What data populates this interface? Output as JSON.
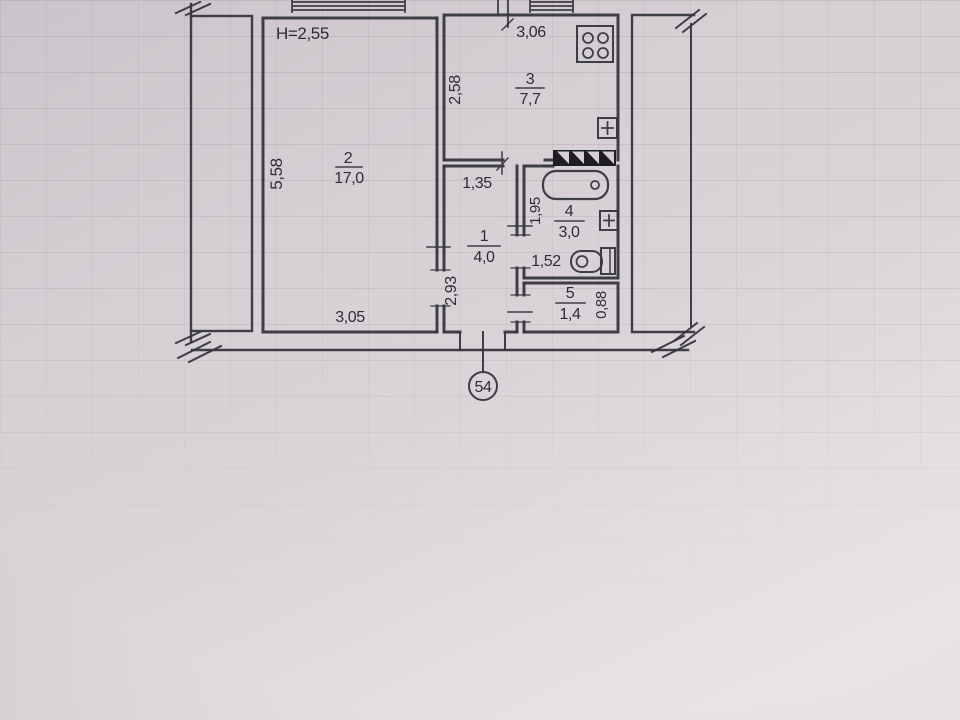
{
  "plan": {
    "title_note": "photographed BTI floor plan sheet",
    "ceiling_height": "H=2,55",
    "apartment_number": "54",
    "rooms": {
      "living": {
        "number": "2",
        "area": "17,0",
        "width": "3,05",
        "depth": "5,58"
      },
      "kitchen": {
        "number": "3",
        "area": "7,7",
        "width": "3,06",
        "depth": "2,58"
      },
      "hall": {
        "number": "1",
        "area": "4,0",
        "width": "1,35",
        "depth": "2,93"
      },
      "bathroom": {
        "number": "4",
        "area": "3,0",
        "width": "1,52",
        "depth": "1,95"
      },
      "wc": {
        "number": "5",
        "area": "1,4",
        "depth": "0,88"
      }
    },
    "icons": [
      "stove-icon",
      "bathtub-icon",
      "toilet-icon",
      "vent-shaft-icon",
      "plus-box-icon"
    ],
    "colors": {
      "ink": "#36363f",
      "paper": "#d5cfd4",
      "vent_black": "#1d1d22"
    }
  }
}
